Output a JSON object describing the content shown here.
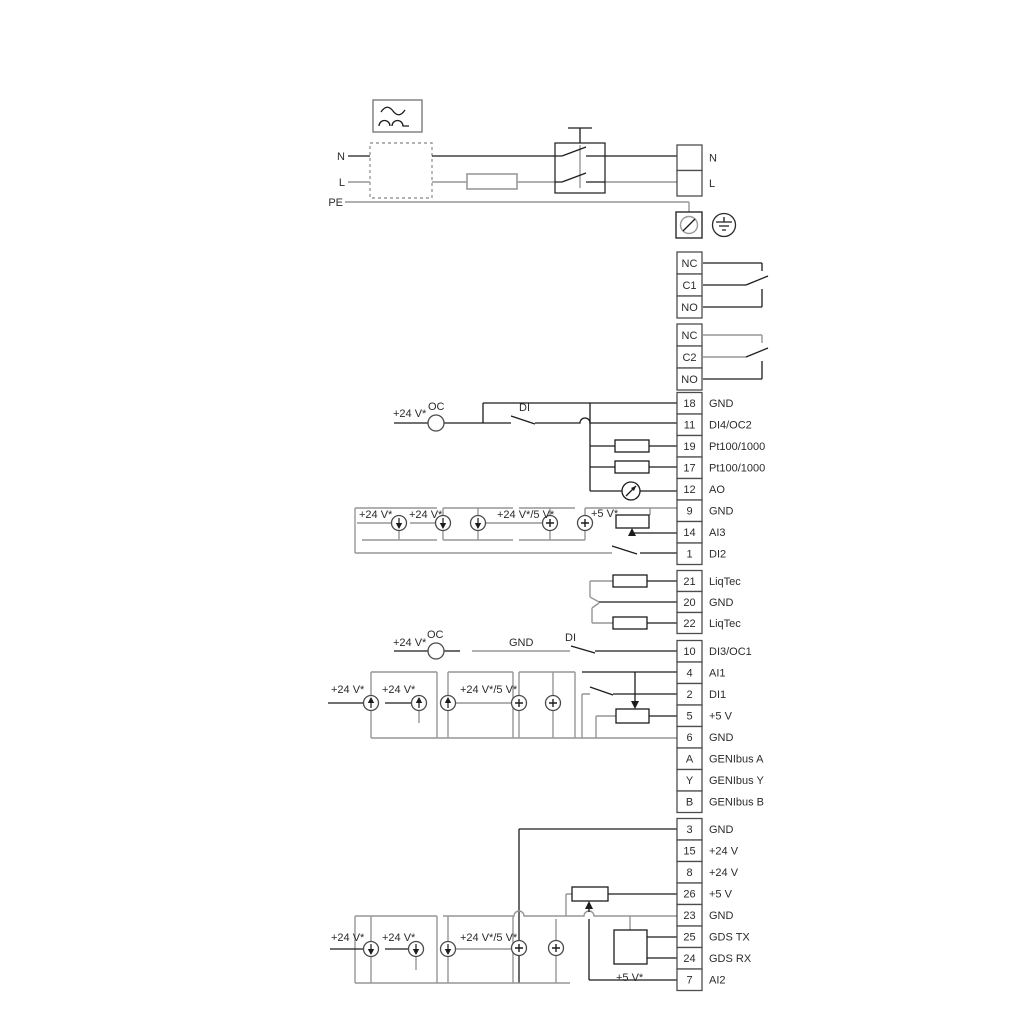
{
  "power": {
    "n_left": "N",
    "l_left": "L",
    "pe": "PE"
  },
  "annotations": {
    "oc_row1": {
      "v24": "+24 V*",
      "oc": "OC",
      "di": "DI"
    },
    "ai3": {
      "v24_a": "+24 V*",
      "v24_b": "+24 V*",
      "v24_5": "+24 V*/5 V*",
      "v5": "+5 V*"
    },
    "oc_row2": {
      "v24": "+24 V*",
      "oc": "OC",
      "gnd": "GND",
      "di": "DI"
    },
    "ai1": {
      "v24_a": "+24 V*",
      "v24_b": "+24 V*",
      "v24_5": "+24 V*/5 V*"
    },
    "ai2": {
      "v24_a": "+24 V*",
      "v24_b": "+24 V*",
      "v24_5": "+24 V*/5 V*",
      "v5": "+5 V*"
    }
  },
  "terminal_blocks": {
    "power_nl": {
      "rows": [
        {
          "id": "",
          "label": "N"
        },
        {
          "id": "",
          "label": "L"
        }
      ]
    },
    "relay1": {
      "rows": [
        {
          "id": "NC",
          "label": ""
        },
        {
          "id": "C1",
          "label": ""
        },
        {
          "id": "NO",
          "label": ""
        }
      ]
    },
    "relay2": {
      "rows": [
        {
          "id": "NC",
          "label": ""
        },
        {
          "id": "C2",
          "label": ""
        },
        {
          "id": "NO",
          "label": ""
        }
      ]
    },
    "io1": {
      "rows": [
        {
          "id": "18",
          "label": "GND"
        },
        {
          "id": "11",
          "label": "DI4/OC2"
        },
        {
          "id": "19",
          "label": "Pt100/1000"
        },
        {
          "id": "17",
          "label": "Pt100/1000"
        },
        {
          "id": "12",
          "label": "AO"
        }
      ]
    },
    "io2": {
      "rows": [
        {
          "id": "9",
          "label": "GND"
        },
        {
          "id": "14",
          "label": "AI3"
        },
        {
          "id": "1",
          "label": "DI2"
        }
      ]
    },
    "liqtec": {
      "rows": [
        {
          "id": "21",
          "label": "LiqTec"
        },
        {
          "id": "20",
          "label": "GND"
        },
        {
          "id": "22",
          "label": "LiqTec"
        }
      ]
    },
    "io3": {
      "rows": [
        {
          "id": "10",
          "label": "DI3/OC1"
        },
        {
          "id": "4",
          "label": "AI1"
        },
        {
          "id": "2",
          "label": "DI1"
        },
        {
          "id": "5",
          "label": "+5 V"
        },
        {
          "id": "6",
          "label": "GND"
        },
        {
          "id": "A",
          "label": "GENIbus A"
        },
        {
          "id": "Y",
          "label": "GENIbus Y"
        },
        {
          "id": "B",
          "label": "GENIbus B"
        }
      ]
    },
    "io4": {
      "rows": [
        {
          "id": "3",
          "label": "GND"
        },
        {
          "id": "15",
          "label": "+24 V"
        },
        {
          "id": "8",
          "label": "+24 V"
        },
        {
          "id": "26",
          "label": "+5 V"
        },
        {
          "id": "23",
          "label": "GND"
        },
        {
          "id": "25",
          "label": "GDS TX"
        },
        {
          "id": "24",
          "label": "GDS RX"
        },
        {
          "id": "7",
          "label": "AI2"
        }
      ]
    }
  },
  "colors": {
    "wire_gray": "#969696",
    "wire_black": "#1c1c1c",
    "background": "#ffffff"
  }
}
